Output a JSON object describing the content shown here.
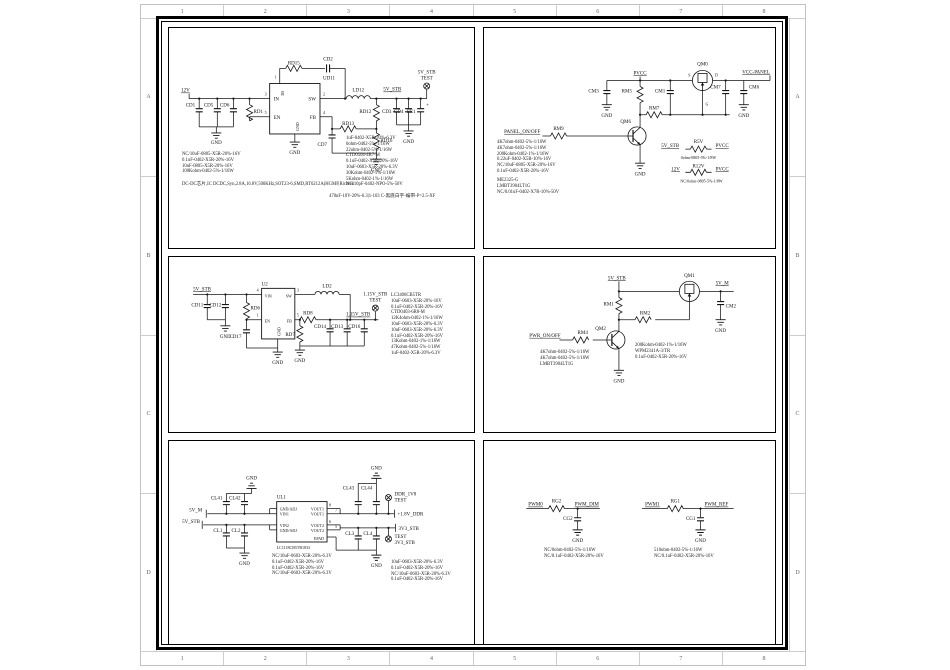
{
  "frame": {
    "cols": [
      "1",
      "2",
      "3",
      "4",
      "5",
      "6",
      "7",
      "8"
    ],
    "rows": [
      "A",
      "B",
      "C",
      "D"
    ]
  },
  "common": {
    "gnd": "GND",
    "test": "TEST",
    "plus": "+"
  },
  "p1": {
    "net_in": "12V",
    "net_out": "5V_STB",
    "ic": "UD11",
    "pin_in": "IN",
    "pin_en": "EN",
    "pin_sw": "SW",
    "pin_fb": "FB",
    "pin_bs": "BS",
    "pin_gnd": "GND",
    "n1": "1",
    "n2": "2",
    "n3": "3",
    "n4": "4",
    "n5": "5",
    "cd1": "CD1",
    "cd5": "CD5",
    "cd6": "CD6",
    "rd1": "RD1",
    "rd15": "RD15",
    "cd2": "CD2",
    "ld12": "LD12",
    "rd12": "RD12",
    "rd13": "RD13",
    "rd16": "RD16",
    "cd7": "CD7",
    "cd3": "CD3",
    "cd4": "CD4",
    "ee1": "EE1",
    "bom_left": [
      "NC/10uF-0805-X5R-20%-16V",
      "0.1uF-0402-X5R-20%-16V",
      "10uF-0805-X5R-20%-16V",
      "100Kohm-0402-5%-1/16W"
    ],
    "desc": "DC-DC芯片,IC DCDC,Syn,2.8A,16.8V,500KHz,SOT23-6,SMD,RT6212A(HGMP,Richtek",
    "bom_right": [
      "1uF-0402-X5R-20%-6.3V",
      "0ohm-0402-5%-1/16W",
      "22ohm-0402-5%-1/16W",
      "CTD0504-4R7-M",
      "0.1uF-0402-X5R-20%-16V",
      "10uF-0603-X5R-20%-6.3V",
      "30Kohm-0402-1%-1/16W",
      "5Kohm-0402-1%-1/16W",
      "NC/10pF-0402-NPO-5%-50V"
    ],
    "note": "470uF-10V-20%-6.3|1-103   C-黑底白字-编带-P=2.5-XF"
  },
  "p2": {
    "pvcc": "PVCC",
    "vcc_panel": "VCC-PANEL",
    "panel_onoff": "PANEL_ON/OFF",
    "cm3": "CM3",
    "rm5": "RM5",
    "cm1": "CM1",
    "qm0": "QM0",
    "s": "S",
    "d": "D",
    "g": "G",
    "cm7": "CM7",
    "cm6": "CM6",
    "rm7": "RM7",
    "qm6": "QM6",
    "rm9": "RM9",
    "r5v": "R5V",
    "r12v": "R12V",
    "v5stb": "5V_STB",
    "v12": "12V",
    "r5v_note": "0ohm-0805-5%-1/8W",
    "r12v_note": "NC/0ohm-0805-5%-1/8W",
    "bom1": [
      "4K7ohm-0402-5%-1/16W",
      "4K7ohm-0402-5%-1/16W",
      "200Kohm-0402-1%-1/16W",
      "0.22uF-0402-X5R-10%-16V",
      "NC/10uF-0805-X5R-20%-16V",
      "0.1uF-0402-X5R-20%-16V"
    ],
    "bom2": [
      "ME2325-G",
      "LMBT3904LT1G",
      "NC/0.01uF-0402-X7R-10%-50V"
    ]
  },
  "p3": {
    "v5stb": "5V_STB",
    "v115": "1.15V_STB",
    "ic": "U2",
    "vin": "VIN",
    "en": "EN",
    "sw": "SW",
    "fb": "FB",
    "gnd": "GND",
    "n4": "4",
    "n1": "1",
    "n3": "3",
    "n5": "5",
    "cd11": "CD11",
    "cd12": "CD12",
    "rd6": "RD6",
    "cd17": "CD17",
    "ld2": "LD2",
    "rd8": "RD8",
    "rd7": "RD7",
    "cd14": "CD14",
    "cd13": "CD13",
    "cd16": "CD16",
    "bom": [
      "LC3406CB5TR",
      "10uF-0603-X5R-20%-16V",
      "0.1uF-0402-X5R-20%-16V",
      "CTD0403-6R8-M",
      "12K4ohm-0402-1%-1/16W",
      "10uF-0603-X5R-20%-6.3V",
      "10uF-0603-X5R-20%-6.3V",
      "0.1uF-0402-X5R-20%-16V",
      "13Kohm-0402-1%-1/16W",
      "47Kohm-0402-5%-1/16W",
      "1uF-0402-X5R-20%-6.3V"
    ]
  },
  "p4": {
    "v5stb": "5V_STB",
    "v5m": "5V_M",
    "pwr_onoff": "PWR_ON/OFF",
    "rm1": "RM1",
    "qm1": "QM1",
    "cm2": "CM2",
    "rm2": "RM2",
    "qm2": "QM2",
    "rm4": "RM4",
    "bom_left": [
      "4K7ohm-0402-5%-1/16W",
      "4K7ohm-0402-5%-1/16W",
      "LMBT3904LT1G"
    ],
    "bom_right": [
      "200Kohm-0402-1%-1/16W",
      "WPM2341A-3/TR",
      "0.1uF-0402-X5R-20%-16V"
    ]
  },
  "p5": {
    "ul1": "UL1",
    "part": "LC1118CB5TR1833",
    "gnd_adj": "GND/ADJ",
    "vin1": "VIN1",
    "vin2": "VIN2",
    "vout1": "VOUT1",
    "vout2": "VOUT2",
    "epad": "EPAD",
    "n8": "8",
    "n7": "7",
    "n6": "6",
    "n5": "5",
    "v5m": "5V_M",
    "v5stb": "5V_STB",
    "v18": "+1.8V_DDR",
    "v3v3": "3V3_STB",
    "ddr": "DDR_1V8",
    "cl41": "CL41",
    "cl42": "CL42",
    "cl1": "CL1",
    "cl2": "CL2",
    "cl43": "CL43",
    "cl44": "CL44",
    "cl3": "CL3",
    "cl4": "CL4",
    "bom_c": [
      "NC/10uF-0603-X5R-20%-6.3V",
      "0.1uF-0402-X5R-20%-16V",
      "0.1uF-0402-X5R-20%-16V",
      "NC/10uF-0603-X5R-20%-6.3V"
    ],
    "bom_r": [
      "10uF-0603-X5R-20%-6.3V",
      "0.1uF-0402-X5R-20%-16V",
      "NC/10uF-0603-X5R-20%-6.3V",
      "0.1uF-0402-X5R-20%-16V"
    ]
  },
  "p6": {
    "pwm0": "PWM0",
    "rg2": "RG2",
    "pwm_dim": "PWM_DIM",
    "cg2": "CG2",
    "pwm1": "PWM1",
    "rg1": "RG1",
    "pwm_ref": "PWM_REF",
    "cg1": "CG1",
    "bom_l": [
      "NC/0ohm-0402-5%-1/16W",
      "NC/0.1uF-0402-X5R-20%-16V"
    ],
    "bom_r": [
      "510ohm-0402-5%-1/16W",
      "NC/0.1uF-0402-X5R-20%-16V"
    ]
  }
}
